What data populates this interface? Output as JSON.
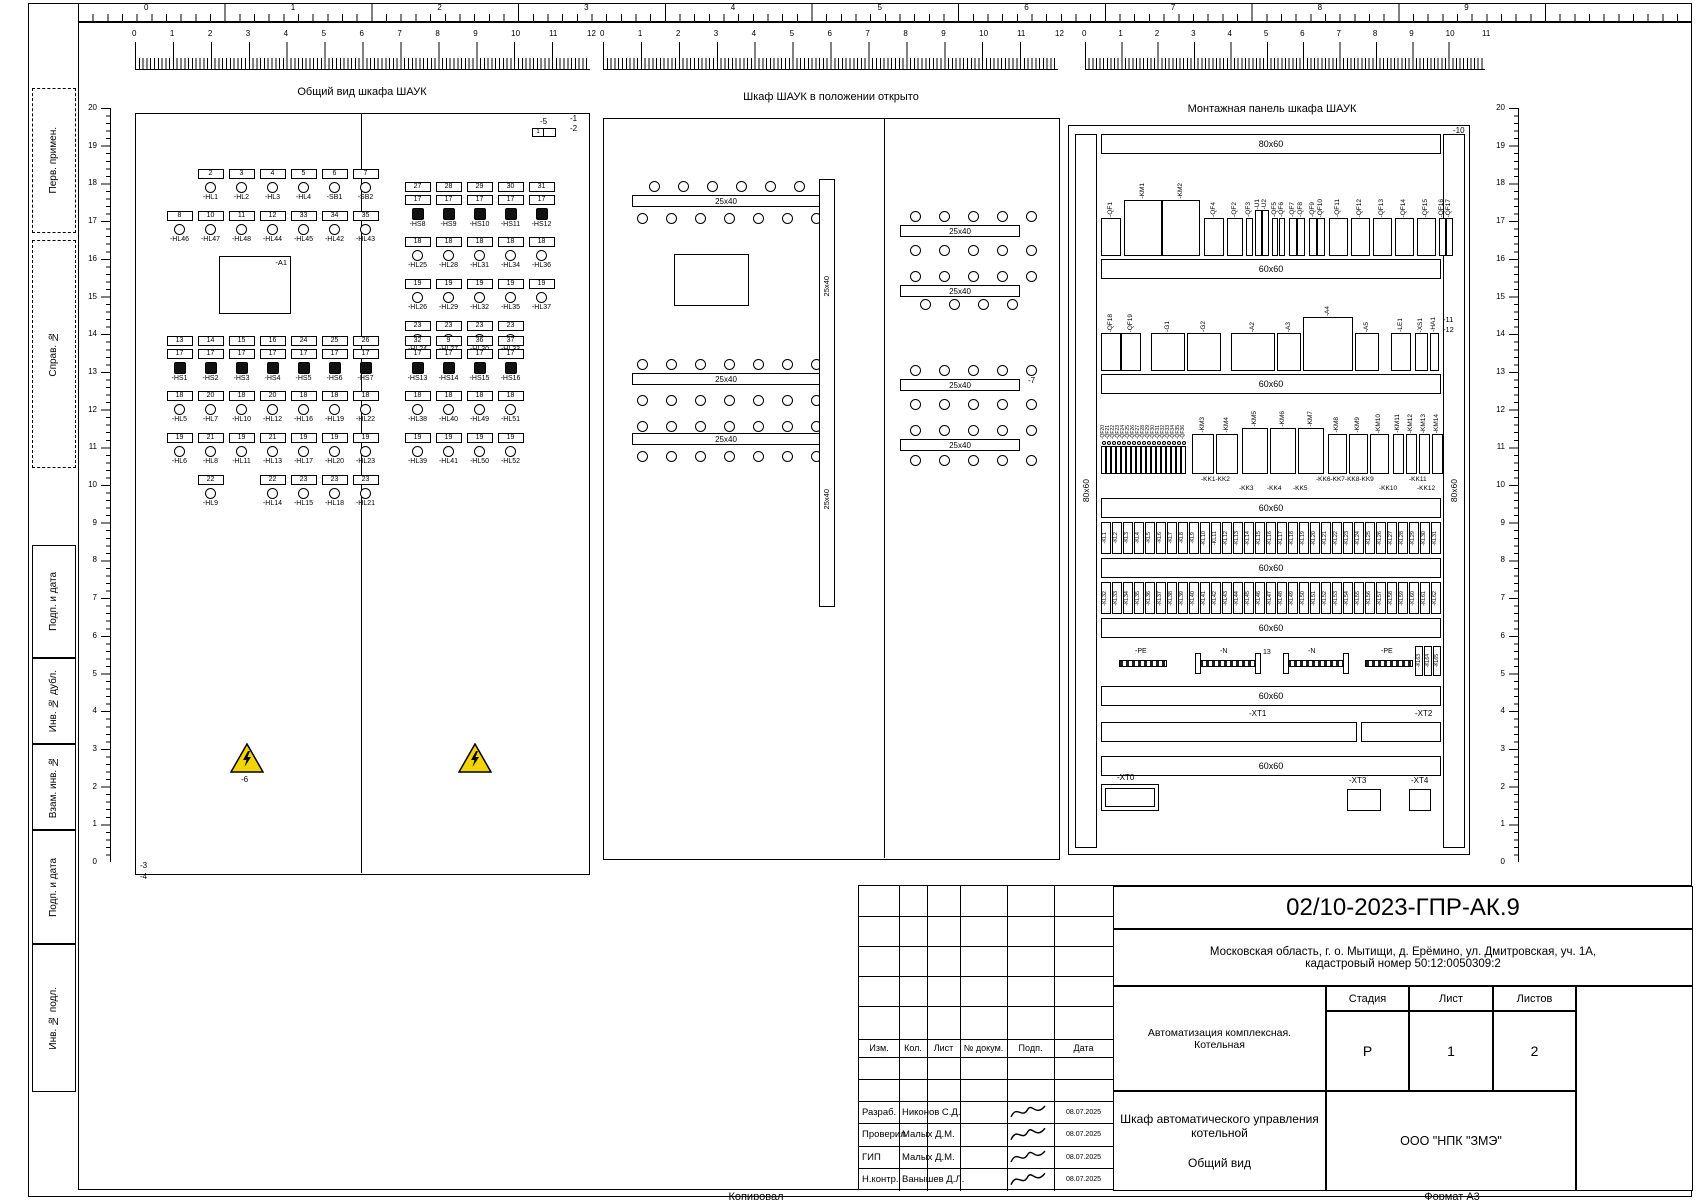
{
  "sheet": {
    "top_numbers": [
      "0",
      "1",
      "2",
      "3",
      "4",
      "5",
      "6",
      "7",
      "8",
      "9"
    ],
    "margin_boxes": [
      {
        "label": "Перв. примен.",
        "y": 88,
        "h": 145,
        "dashed": true
      },
      {
        "label": "Справ. №",
        "y": 240,
        "h": 228,
        "dashed": true
      },
      {
        "label": "Подп. и дата",
        "y": 545,
        "h": 113,
        "dashed": false
      },
      {
        "label": "Инв. № дубл.",
        "y": 658,
        "h": 86,
        "dashed": false
      },
      {
        "label": "Взам. инв. №",
        "y": 744,
        "h": 86,
        "dashed": false
      },
      {
        "label": "Подп. и дата",
        "y": 830,
        "h": 114,
        "dashed": false
      },
      {
        "label": "Инв. № подл.",
        "y": 944,
        "h": 148,
        "dashed": false
      }
    ],
    "footer": {
      "copied": "Копировал",
      "format": "Формат  А3"
    }
  },
  "front": {
    "title": "Общий вид шкафа ШАУК",
    "ruler": {
      "from": 0,
      "to": 12
    },
    "callouts": {
      "c5": "-5",
      "c5_inner": "1",
      "c1": "-1",
      "c2": "-2",
      "c3": "-3",
      "c4": "-4",
      "c6": "-6",
      "a1": "-A1"
    },
    "blocks": [
      {
        "x": 28,
        "y": 55,
        "rows": "rlrl",
        "cols": [
          [
            "",
            "",
            "r:8",
            "l:-HL46"
          ],
          [
            "r:2",
            "l:-HL1",
            "r:10",
            "l:-HL47"
          ],
          [
            "r:3",
            "l:-HL2",
            "r:11",
            "l:-HL48"
          ],
          [
            "r:4",
            "l:-HL3",
            "r:12",
            "l:-HL44"
          ],
          [
            "r:5",
            "l:-HL4",
            "r:33",
            "l:-HL45"
          ],
          [
            "r:6",
            "l:-SB1",
            "r:34",
            "l:-HL42"
          ],
          [
            "r:7",
            "l:-SB2",
            "r:35",
            "l:-HL43"
          ]
        ]
      },
      {
        "x": 28,
        "y": 222,
        "rows": "rrbrlrlrl",
        "cols": [
          [
            "r:13",
            "r:17",
            "b:-HS1",
            "r:18",
            "l:-HL5",
            "r:19",
            "l:-HL6",
            "",
            ""
          ],
          [
            "r:14",
            "r:17",
            "b:-HS2",
            "r:20",
            "l:-HL7",
            "r:21",
            "l:-HL8",
            "r:22",
            "l:-HL9"
          ],
          [
            "r:15",
            "r:17",
            "b:-HS3",
            "r:18",
            "l:-HL10",
            "r:19",
            "l:-HL11",
            "",
            ""
          ],
          [
            "r:16",
            "r:17",
            "b:-HS4",
            "r:20",
            "l:-HL12",
            "r:21",
            "l:-HL13",
            "r:22",
            "l:-HL14"
          ],
          [
            "r:24",
            "r:17",
            "b:-HS5",
            "r:18",
            "l:-HL16",
            "r:19",
            "l:-HL17",
            "r:23",
            "l:-HL15"
          ],
          [
            "r:25",
            "r:17",
            "b:-HS6",
            "r:18",
            "l:-HL19",
            "r:19",
            "l:-HL20",
            "r:23",
            "l:-HL18"
          ],
          [
            "r:26",
            "r:17",
            "b:-HS7",
            "r:18",
            "l:-HL22",
            "r:19",
            "l:-HL23",
            "r:23",
            "l:-HL21"
          ]
        ]
      },
      {
        "x": 266,
        "y": 68,
        "rows": "rrbrlrlrl",
        "cols": [
          [
            "r:27",
            "r:17",
            "b:-HS8",
            "r:18",
            "l:-HL25",
            "r:19",
            "l:-HL26",
            "r:23",
            "l:-HL24"
          ],
          [
            "r:28",
            "r:17",
            "b:-HS9",
            "r:18",
            "l:-HL28",
            "r:19",
            "l:-HL29",
            "r:23",
            "l:-HL27"
          ],
          [
            "r:29",
            "r:17",
            "b:-HS10",
            "r:18",
            "l:-HL31",
            "r:19",
            "l:-HL32",
            "r:23",
            "l:-HL30"
          ],
          [
            "r:30",
            "r:17",
            "b:-HS11",
            "r:18",
            "l:-HL34",
            "r:19",
            "l:-HL35",
            "r:23",
            "l:-HL33"
          ],
          [
            "r:31",
            "r:17",
            "b:-HS12",
            "r:18",
            "l:-HL36",
            "r:19",
            "l:-HL37",
            "",
            ""
          ]
        ]
      },
      {
        "x": 266,
        "y": 222,
        "rows": "rrbrlrl",
        "cols": [
          [
            "r:32",
            "r:17",
            "b:-HS13",
            "r:18",
            "l:-HL38",
            "r:19",
            "l:-HL39"
          ],
          [
            "r:9",
            "r:17",
            "b:-HS14",
            "r:18",
            "l:-HL40",
            "r:19",
            "l:-HL41"
          ],
          [
            "r:36",
            "r:17",
            "b:-HS15",
            "r:18",
            "l:-HL49",
            "r:19",
            "l:-HL50"
          ],
          [
            "r:37",
            "r:17",
            "b:-HS16",
            "r:18",
            "l:-HL51",
            "r:19",
            "l:-HL52"
          ]
        ]
      }
    ]
  },
  "open": {
    "title": "Шкаф ШАУК в положении открыто",
    "ruler": {
      "from": 0,
      "to": 12
    },
    "duct_label": "25x40",
    "callout": "-7",
    "left_holes": [
      [
        45,
        62,
        6
      ],
      [
        33,
        94,
        7
      ],
      [
        33,
        240,
        7
      ],
      [
        33,
        276,
        7
      ],
      [
        33,
        302,
        7
      ],
      [
        33,
        332,
        7
      ]
    ],
    "right_holes": [
      [
        306,
        92,
        5
      ],
      [
        306,
        126,
        5
      ],
      [
        306,
        152,
        5
      ],
      [
        316,
        180,
        4
      ],
      [
        306,
        246,
        5
      ],
      [
        306,
        280,
        5
      ],
      [
        306,
        306,
        5
      ],
      [
        306,
        336,
        5
      ]
    ],
    "left_ducts": [
      [
        28,
        76
      ],
      [
        28,
        254
      ],
      [
        28,
        314
      ]
    ],
    "right_ducts": [
      [
        296,
        106
      ],
      [
        296,
        166
      ],
      [
        296,
        260
      ],
      [
        296,
        320
      ]
    ]
  },
  "panel": {
    "title": "Монтажная панель шкафа ШАУК",
    "ruler": {
      "from": 0,
      "to": 11
    },
    "side_duct_label": "80x60",
    "callout_top": "-10",
    "callouts_right": [
      "-11",
      "-12"
    ],
    "n_note": "13",
    "ducts": [
      {
        "y": 8,
        "label": "80x60"
      },
      {
        "y": 133,
        "label": "60x60"
      },
      {
        "y": 248,
        "label": "60x60"
      },
      {
        "y": 372,
        "label": "60x60"
      },
      {
        "y": 432,
        "label": "60x60"
      },
      {
        "y": 492,
        "label": "60x60"
      },
      {
        "y": 560,
        "label": "60x60"
      },
      {
        "y": 630,
        "label": "60x60"
      }
    ],
    "rail1": [
      {
        "l": "-QF1",
        "w": 20
      },
      {
        "l": "-KM1",
        "w": 38,
        "h": 56,
        "g": 3
      },
      {
        "l": "-KM2",
        "w": 38,
        "h": 56
      },
      {
        "l": "-QF4",
        "w": 20,
        "g": 4
      },
      {
        "l": "-QF2",
        "w": 16,
        "g": 3
      },
      {
        "l": "-QF3",
        "w": 7,
        "g": 3
      },
      {
        "l": "-U1",
        "w": 7,
        "h": 46,
        "g": 2
      },
      {
        "l": "-U2",
        "w": 7,
        "h": 46
      },
      {
        "l": "-QF5",
        "w": 6,
        "g": 3
      },
      {
        "l": "-QF6",
        "w": 6
      },
      {
        "l": "-QF7",
        "w": 8,
        "g": 4
      },
      {
        "l": "-QF8",
        "w": 8
      },
      {
        "l": "-QF9",
        "w": 8,
        "g": 4
      },
      {
        "l": "-QF10",
        "w": 8
      },
      {
        "l": "-QF11",
        "w": 19,
        "g": 4
      },
      {
        "l": "-QF12",
        "w": 19,
        "g": 3
      },
      {
        "l": "-QF13",
        "w": 19,
        "g": 3
      },
      {
        "l": "-QF14",
        "w": 19,
        "g": 3
      },
      {
        "l": "-QF15",
        "w": 19,
        "g": 3
      },
      {
        "l": "-QF16",
        "w": 7,
        "g": 3
      },
      {
        "l": "-QF17",
        "w": 7
      }
    ],
    "rail2": [
      {
        "l": "-QF18",
        "w": 20
      },
      {
        "l": "-QF19",
        "w": 20
      },
      {
        "l": "-G1",
        "w": 34,
        "g": 10
      },
      {
        "l": "-G2",
        "w": 34,
        "g": 2
      },
      {
        "l": "-A2",
        "w": 44,
        "g": 10
      },
      {
        "l": "-A3",
        "w": 24,
        "g": 2
      },
      {
        "l": "-A4",
        "w": 50,
        "h": 54,
        "g": 2
      },
      {
        "l": "-A5",
        "w": 24,
        "g": 2
      },
      {
        "l": "-LE1",
        "w": 20,
        "g": 12
      },
      {
        "l": "-XS1",
        "w": 13,
        "g": 4
      },
      {
        "l": "-HA1",
        "w": 9,
        "g": 2
      }
    ],
    "rail3": [
      {
        "l": "-QF20",
        "w": 5,
        "h": 28,
        "mini": true
      },
      {
        "l": "-QF21",
        "w": 5,
        "h": 28,
        "mini": true
      },
      {
        "l": "-QF22",
        "w": 5,
        "h": 28,
        "mini": true
      },
      {
        "l": "-QF23",
        "w": 5,
        "h": 28,
        "mini": true
      },
      {
        "l": "-QF24",
        "w": 5,
        "h": 28,
        "mini": true
      },
      {
        "l": "-QF25",
        "w": 5,
        "h": 28,
        "mini": true
      },
      {
        "l": "-QF26",
        "w": 5,
        "h": 28,
        "mini": true
      },
      {
        "l": "-QF27",
        "w": 5,
        "h": 28,
        "mini": true
      },
      {
        "l": "-QF28",
        "w": 5,
        "h": 28,
        "mini": true
      },
      {
        "l": "-QF29",
        "w": 5,
        "h": 28,
        "mini": true
      },
      {
        "l": "-QF30",
        "w": 5,
        "h": 28,
        "mini": true
      },
      {
        "l": "-QF31",
        "w": 5,
        "h": 28,
        "mini": true
      },
      {
        "l": "-QF32",
        "w": 5,
        "h": 28,
        "mini": true
      },
      {
        "l": "-QF33",
        "w": 5,
        "h": 28,
        "mini": true
      },
      {
        "l": "-QF34",
        "w": 5,
        "h": 28,
        "mini": true
      },
      {
        "l": "-QF35",
        "w": 5,
        "h": 28,
        "mini": true
      },
      {
        "l": "-QF36",
        "w": 5,
        "h": 28,
        "mini": true
      },
      {
        "l": "-KM3",
        "w": 22,
        "h": 40,
        "g": 6
      },
      {
        "l": "-KM4",
        "w": 22,
        "h": 40,
        "g": 2
      },
      {
        "l": "-KM5",
        "w": 26,
        "h": 46,
        "g": 4
      },
      {
        "l": "-KM6",
        "w": 26,
        "h": 46,
        "g": 2
      },
      {
        "l": "-KM7",
        "w": 26,
        "h": 46,
        "g": 2
      },
      {
        "l": "-KM8",
        "w": 19,
        "h": 40,
        "g": 4
      },
      {
        "l": "-KM9",
        "w": 19,
        "h": 40,
        "g": 2
      },
      {
        "l": "-KM10",
        "w": 19,
        "h": 40,
        "g": 2
      },
      {
        "l": "-KM11",
        "w": 11,
        "h": 40,
        "g": 4
      },
      {
        "l": "-KM12",
        "w": 11,
        "h": 40,
        "g": 2
      },
      {
        "l": "-KM13",
        "w": 11,
        "h": 40,
        "g": 2
      },
      {
        "l": "-KM14",
        "w": 11,
        "h": 40,
        "g": 2
      }
    ],
    "kk_row1": [
      [
        "-KK1-KK2",
        100
      ],
      [
        "-KK6-KK7-KK8-KK9",
        215
      ],
      [
        "-KK11",
        308
      ]
    ],
    "kk_row2": [
      [
        "-KK3",
        138
      ],
      [
        "-KK4",
        166
      ],
      [
        "-KK5",
        192
      ],
      [
        "-KK10",
        278
      ],
      [
        "-KK12",
        316
      ]
    ],
    "kl_row1": [
      "-KL1",
      "-KL2",
      "-KL3",
      "-KL4",
      "-KL5",
      "-KL6",
      "-KL7",
      "-KL8",
      "-KL9",
      "-KL10",
      "-KL11",
      "-KL12",
      "-KL13",
      "-KL14",
      "-KL15",
      "-KL16",
      "-KL17",
      "-KL18",
      "-KL19",
      "-KL20",
      "-KL21",
      "-KL22",
      "-KL23",
      "-KL24",
      "-KL25",
      "-KL26",
      "-KL27",
      "-KL28",
      "-KL29",
      "-KL30",
      "-KL31"
    ],
    "kl_row2": [
      "-KL32",
      "-KL33",
      "-KL34",
      "-KL35",
      "-KL36",
      "-KL37",
      "-KL38",
      "-KL39",
      "-KL40",
      "-KL41",
      "-KL42",
      "-KL43",
      "-KL44",
      "-KL45",
      "-KL46",
      "-KL47",
      "-KL48",
      "-KL49",
      "-KL50",
      "-KL51",
      "-KL52",
      "-KL53",
      "-KL54",
      "-KL55",
      "-KL56",
      "-KL57",
      "-KL58",
      "-KL59",
      "-KL60",
      "-KL61",
      "-KL62"
    ],
    "kl_row3": [
      "-KL63",
      "-KL64",
      "-KL65"
    ],
    "bars": [
      {
        "label": "-PE",
        "x": 18,
        "w": 48,
        "note": false
      },
      {
        "label": "-N",
        "x": 98,
        "w": 58,
        "note": true
      },
      {
        "label": "-N",
        "x": 186,
        "w": 58,
        "note": false
      },
      {
        "label": "-PE",
        "x": 264,
        "w": 48,
        "note": false
      }
    ],
    "xt": {
      "xt0": "-XT0",
      "xt1": "-XT1",
      "xt2": "-XT2",
      "xt3": "-XT3",
      "xt4": "-XT4"
    }
  },
  "title_block": {
    "doc_number": "02/10-2023-ГПР-АК.9",
    "address_line1": "Московская область, г. о. Мытищи, д. Ерёмино, ул. Дмитровская, уч. 1А,",
    "address_line2": "кадастровый номер 50:12:0050309:2",
    "header_cols": [
      "Изм.",
      "Кол.",
      "Лист",
      "№ докум.",
      "Подп.",
      "Дата"
    ],
    "rows": [
      {
        "role": "Разраб.",
        "name": "Никонов С.Д.",
        "date": "08.07.2025"
      },
      {
        "role": "Проверил",
        "name": "Малых Д.М.",
        "date": "08.07.2025"
      },
      {
        "role": "ГИП",
        "name": "Малых Д.М.",
        "date": "08.07.2025"
      },
      {
        "role": "Н.контр.",
        "name": "Ванышев Д.Л.",
        "date": "08.07.2025"
      }
    ],
    "project_type": "Автоматизация комплексная. Котельная",
    "subject": "Шкаф автоматического управления котельной",
    "view_name": "Общий вид",
    "stage_label": "Стадия",
    "sheet_label": "Лист",
    "sheets_label": "Листов",
    "stage": "Р",
    "sheet_no": "1",
    "sheets_total": "2",
    "company": "ООО \"НПК \"ЗМЭ\""
  }
}
